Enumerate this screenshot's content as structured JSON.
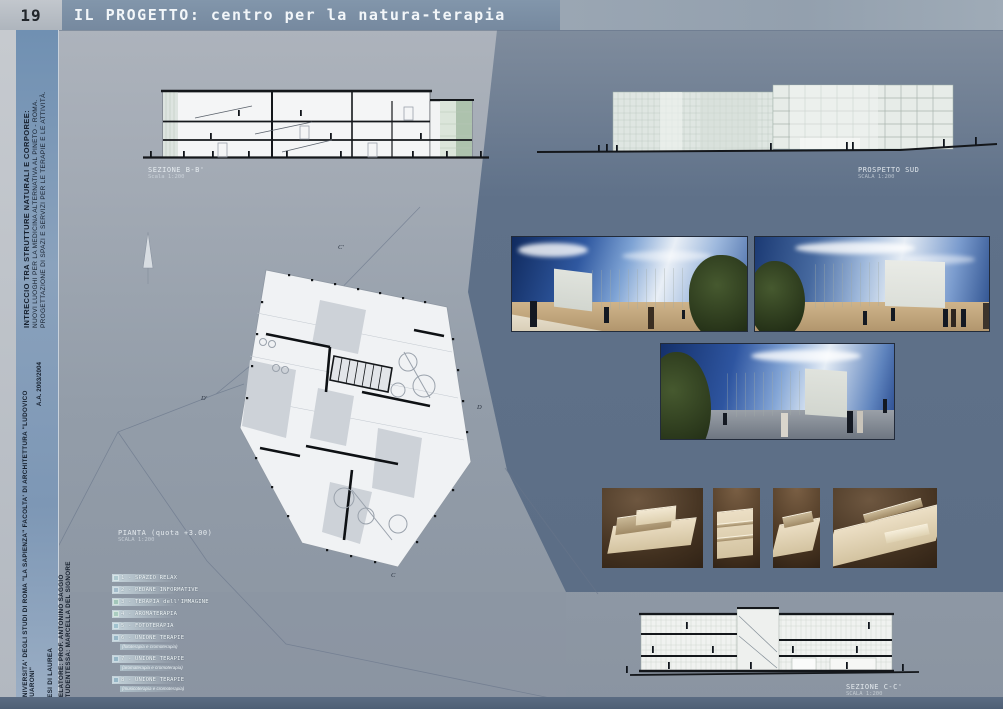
{
  "header": {
    "page_number": "19",
    "title": "IL PROGETTO: centro per la natura-terapia"
  },
  "sidebar": {
    "project_title": "INTRECCIO TRA STRUTTURE NATURALI E CORPOREE:",
    "project_line2": "NUOVI LUOGHI PER LA MEDICINA ALTERNATIVA AL PINETO - ROMA.",
    "project_line3": "PROGETTAZIONE DI SPAZI E SERVIZI PER LE TERAPIE E LE ATTIVITÀ.",
    "university": "UNIVERSITA' DEGLI STUDI DI ROMA \"LA SAPIENZA\" FACOLTA' DI ARCHITETTURA \"LUDOVICO QUARONI\"",
    "academic_year": "A.A. 2003/2004",
    "thesis": "TESI DI LAUREA",
    "advisor": "RELATORE: PROF. ANTONINO SAGGIO",
    "student": "STUDENTESSA: MARCELLA DEL SIGNORE"
  },
  "drawings": {
    "section_bb": {
      "label": "SEZIONE B-B'",
      "scale": "Scala 1:200"
    },
    "prospetto_sud": {
      "label": "PROSPETTO SUD",
      "scale": "SCALA 1:200"
    },
    "pianta": {
      "label": "PIANTA (quota +3.00)",
      "scale": "SCALA 1:200"
    },
    "section_cc": {
      "label": "SEZIONE C-C'",
      "scale": "SCALA 1:200"
    },
    "plan_markers": [
      "C'",
      "D'",
      "D",
      "C"
    ]
  },
  "legend": {
    "items": [
      {
        "n": "1",
        "label": "SPAZIO RELAX",
        "color": "#aec9cf"
      },
      {
        "n": "2",
        "label": "PEDANE INFORMATIVE",
        "color": "#a3bccb"
      },
      {
        "n": "3",
        "label": "TERAPIA dell'IMMAGINE",
        "color": "#a2c6ba"
      },
      {
        "n": "4",
        "label": "AROMATERAPIA",
        "color": "#aacdc0"
      },
      {
        "n": "5",
        "label": "FOTOTERAPIA",
        "color": "#a0c2cf"
      },
      {
        "n": "6",
        "label": "UNIONE TERAPIE",
        "sub": "(fototerapia e cromoterapia)",
        "color": "#96b6c6"
      },
      {
        "n": "7",
        "label": "UNIONE TERAPIE",
        "sub": "(aromaterapia e cromoterapia)",
        "color": "#96b6c6"
      },
      {
        "n": "8",
        "label": "UNIONE TERAPIE",
        "sub": "(musicoterapia e cromoterapia)",
        "color": "#96b6c6"
      }
    ]
  },
  "colors": {
    "header_bar": "#7b8fa5",
    "sidebar_blue": "#7f9ab8",
    "background_light": "#a9afb9",
    "background_dark": "#5f7189",
    "drawing_ink": "#16181c",
    "glass_green": "#dfe6e2",
    "render_sky": "#2f58a0",
    "render_ground": "#c2a379",
    "model_brown": "#41301f"
  }
}
